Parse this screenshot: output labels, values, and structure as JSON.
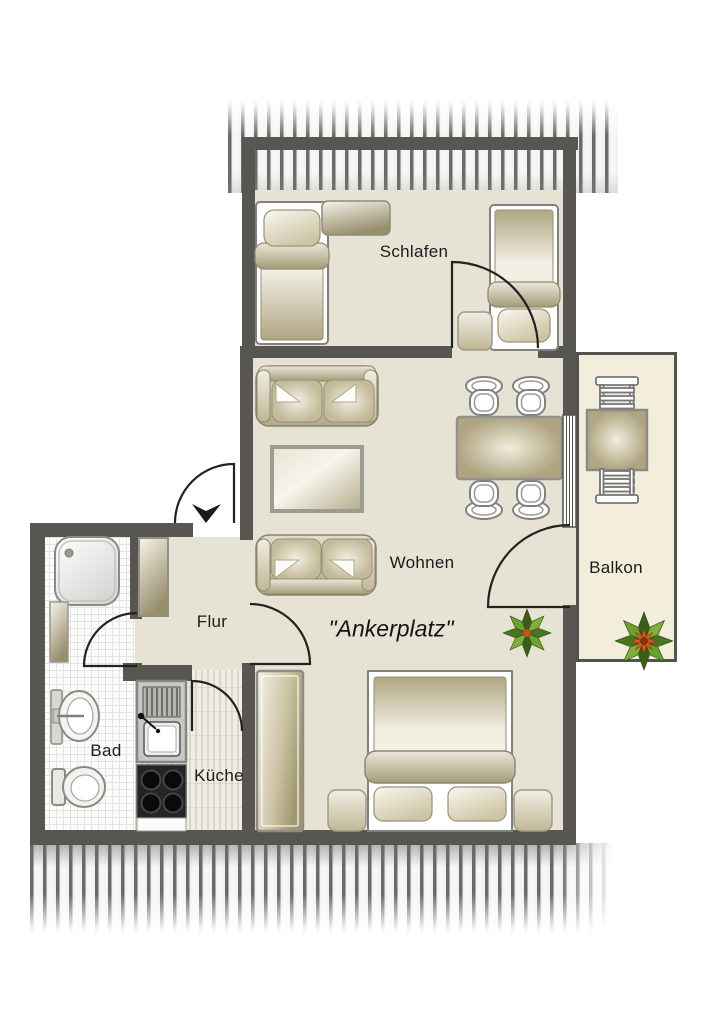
{
  "floorplan": {
    "apartment_name": "\"Ankerplatz\"",
    "rooms": [
      {
        "id": "schlafen",
        "label": "Schlafen"
      },
      {
        "id": "wohnen",
        "label": "Wohnen"
      },
      {
        "id": "balkon",
        "label": "Balkon"
      },
      {
        "id": "flur",
        "label": "Flur"
      },
      {
        "id": "bad",
        "label": "Bad"
      },
      {
        "id": "kueche",
        "label": "Küche"
      }
    ],
    "colors": {
      "wall": "#575650",
      "room_floor": "#e6e2d4",
      "balcony_floor": "#f2eedb",
      "roof_hatch_stripe": "#6a6a6a",
      "furniture_beige": "#b6ad8c",
      "plant_green": "#4a7d22",
      "flower_orange": "#d95f28"
    }
  }
}
